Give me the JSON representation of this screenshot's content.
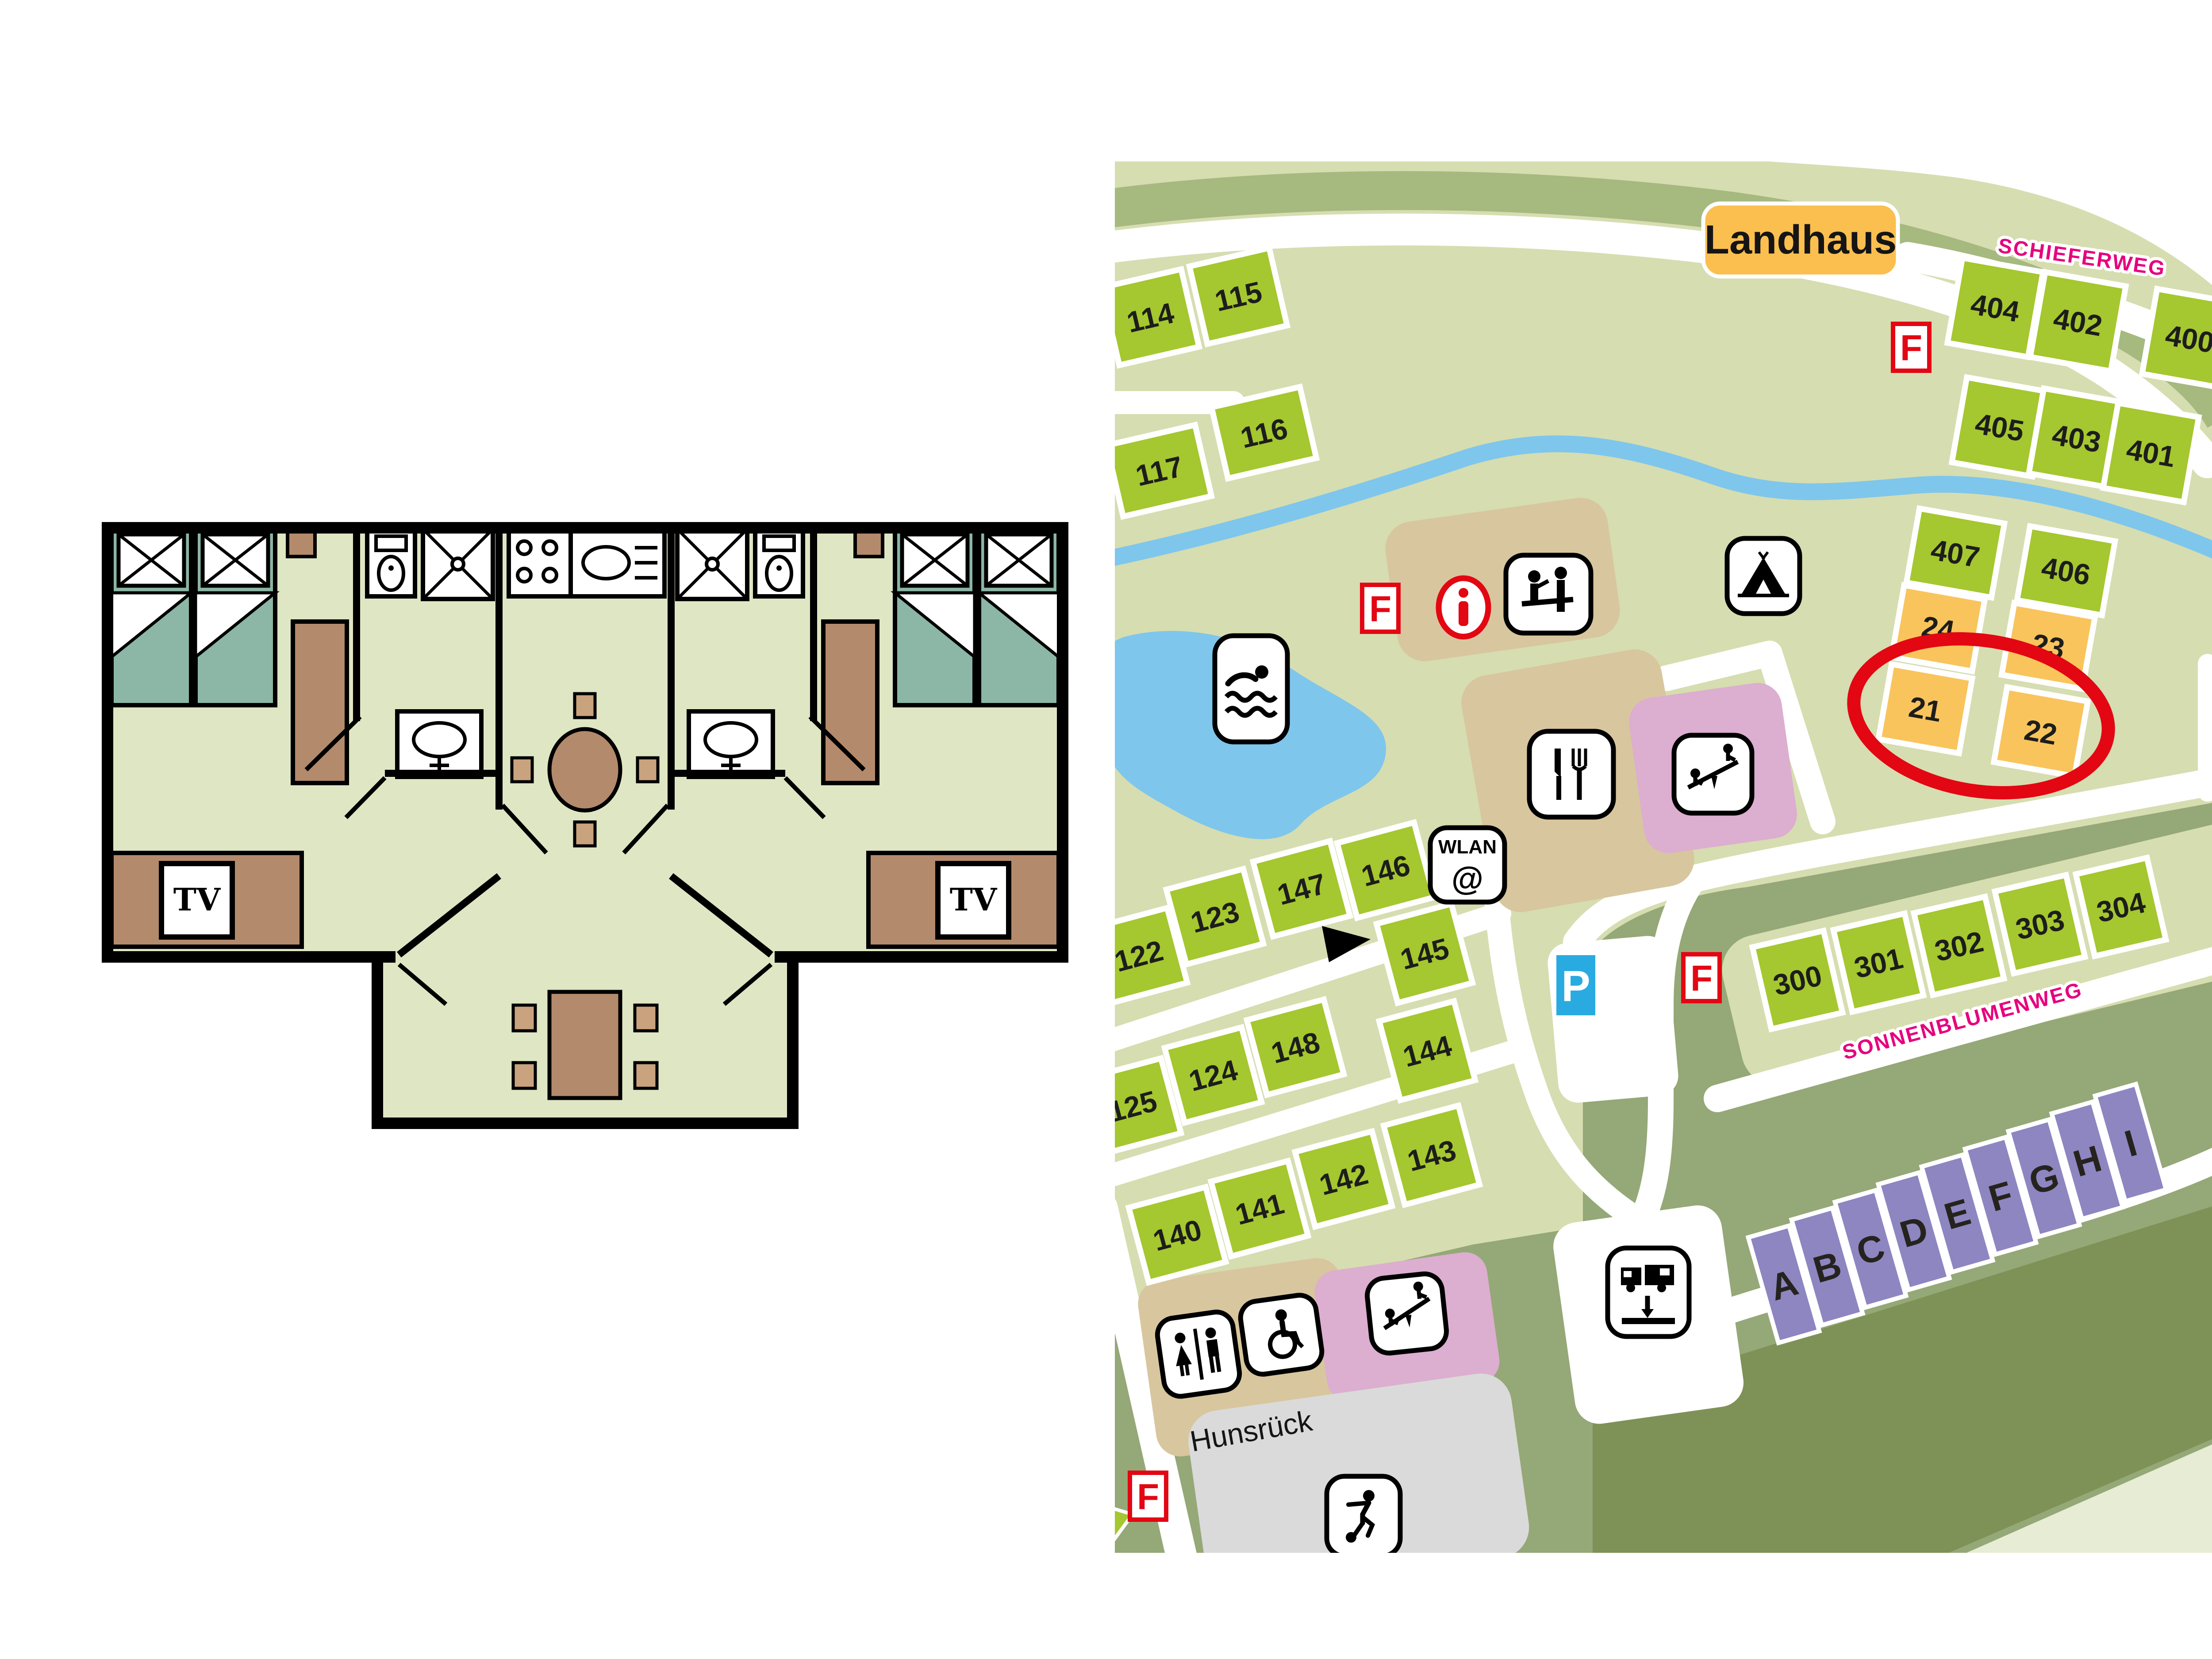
{
  "floor_plan": {
    "tv_label": "TV"
  },
  "map": {
    "labels": {
      "landhaus": "Landhaus",
      "hunsrueck": "Hunsrück",
      "wlan": "WLAN",
      "at_sign": "@",
      "parking": "P",
      "fire": "F"
    },
    "streets": [
      {
        "name": "SCHIEFERWEG"
      },
      {
        "name": "SONNENBLUMENWEG"
      }
    ],
    "plots": [
      {
        "label": "114",
        "type": "green"
      },
      {
        "label": "115",
        "type": "green"
      },
      {
        "label": "116",
        "type": "green"
      },
      {
        "label": "117",
        "type": "green"
      },
      {
        "label": "404",
        "type": "green"
      },
      {
        "label": "402",
        "type": "green"
      },
      {
        "label": "400",
        "type": "green"
      },
      {
        "label": "405",
        "type": "green"
      },
      {
        "label": "403",
        "type": "green"
      },
      {
        "label": "401",
        "type": "green"
      },
      {
        "label": "407",
        "type": "green"
      },
      {
        "label": "406",
        "type": "green"
      },
      {
        "label": "300",
        "type": "green"
      },
      {
        "label": "301",
        "type": "green"
      },
      {
        "label": "302",
        "type": "green"
      },
      {
        "label": "303",
        "type": "green"
      },
      {
        "label": "304",
        "type": "green"
      },
      {
        "label": "122",
        "type": "green"
      },
      {
        "label": "123",
        "type": "green"
      },
      {
        "label": "147",
        "type": "green"
      },
      {
        "label": "146",
        "type": "green"
      },
      {
        "label": "145",
        "type": "green"
      },
      {
        "label": "148",
        "type": "green"
      },
      {
        "label": "124",
        "type": "green"
      },
      {
        "label": "125",
        "type": "green"
      },
      {
        "label": "144",
        "type": "green"
      },
      {
        "label": "143",
        "type": "green"
      },
      {
        "label": "142",
        "type": "green"
      },
      {
        "label": "141",
        "type": "green"
      },
      {
        "label": "140",
        "type": "green"
      },
      {
        "label": "24",
        "type": "orange"
      },
      {
        "label": "23",
        "type": "orange"
      },
      {
        "label": "21",
        "type": "orange"
      },
      {
        "label": "22",
        "type": "orange"
      }
    ],
    "letter_plots": [
      "A",
      "B",
      "C",
      "D",
      "E",
      "F",
      "G",
      "H",
      "I"
    ],
    "selection": {
      "circled_plots": [
        "21",
        "22"
      ]
    },
    "colors": {
      "plot_green": "#a5c72f",
      "plot_orange": "#f9c45c",
      "plot_purple": "#8d86c1",
      "street_magenta": "#e6007e",
      "highlight_red": "#e30613",
      "water_blue": "#7ec6ec",
      "parking_blue": "#29abe2",
      "landhaus_orange": "#fbbf4f",
      "building_tan": "#d8c69e",
      "play_pink": "#dcaecf",
      "court_grey": "#dadada"
    }
  }
}
